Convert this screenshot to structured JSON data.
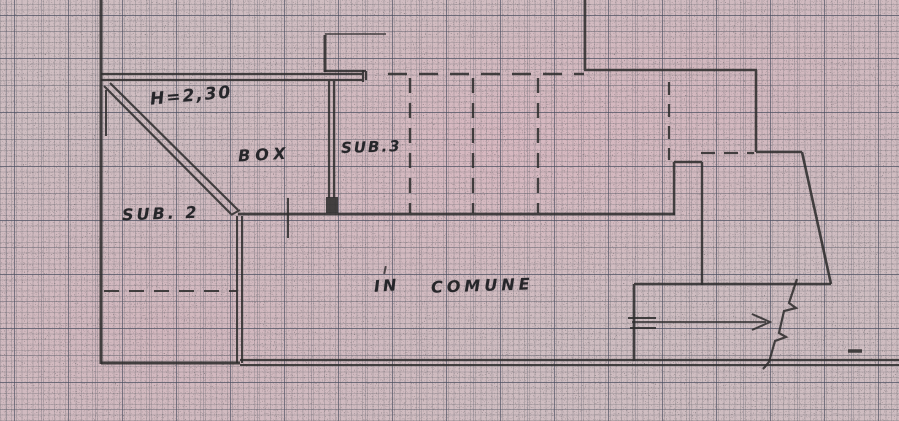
{
  "plan": {
    "labels": {
      "height": "H=2,30",
      "box": "BOX",
      "sub3": "SUB.3",
      "sub2": "SUB. 2",
      "in": "IN",
      "comune": "COMUNE"
    },
    "colors": {
      "paper": "#cfbdc1",
      "ink": "#2f2d2e"
    }
  }
}
